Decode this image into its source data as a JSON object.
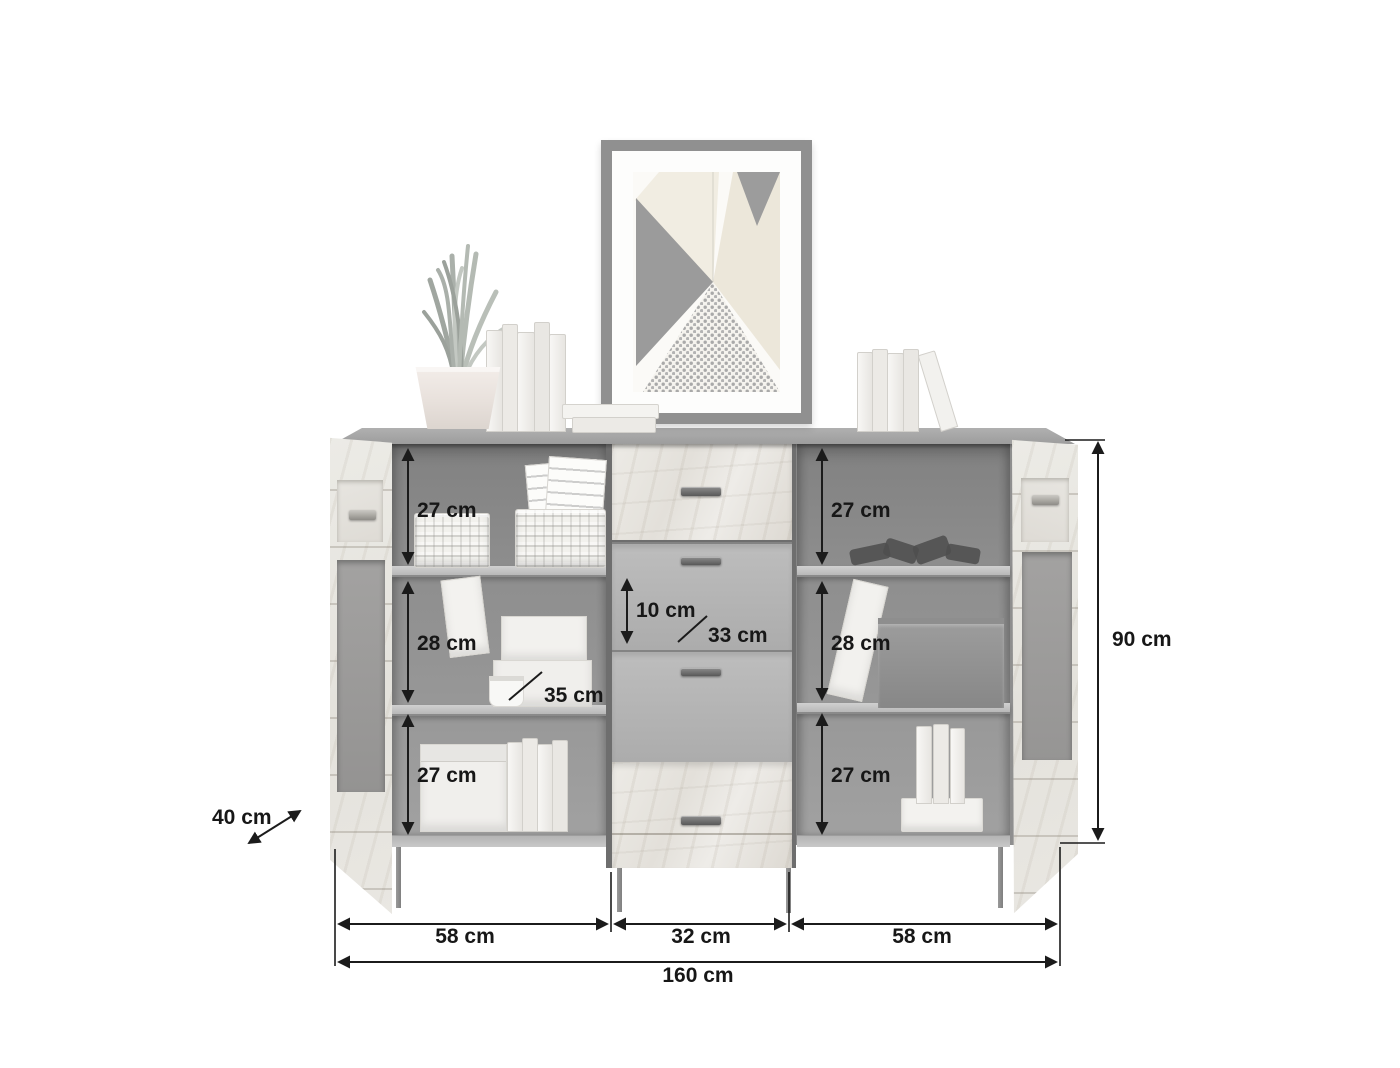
{
  "diagram": {
    "kind": "furniture-dimension-diagram",
    "product": "sideboard with two glass doors and four drawers",
    "dimensions": {
      "shelf_top_left": "27 cm",
      "shelf_middle_left": "28 cm",
      "shelf_bottom_left": "27 cm",
      "shelf_top_right": "27 cm",
      "shelf_middle_right": "28 cm",
      "shelf_bottom_right": "27 cm",
      "drawer_inner_height": "10 cm",
      "drawer_inner_width": "33 cm",
      "compartment_inner_width": "35 cm",
      "depth": "40 cm",
      "height": "90 cm",
      "section_width_left": "58 cm",
      "section_width_center": "32 cm",
      "section_width_right": "58 cm",
      "total_width": "160 cm"
    }
  }
}
